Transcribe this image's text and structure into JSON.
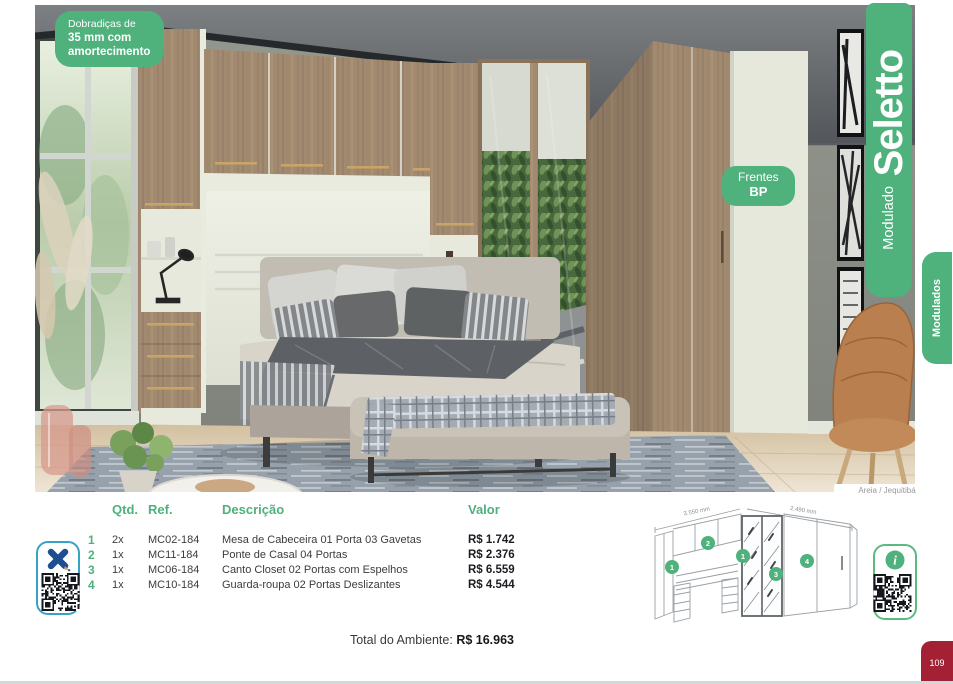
{
  "page": {
    "number": "109"
  },
  "photo": {
    "badge_hinges": {
      "line1": "Dobradiças de",
      "line2": "35 mm com",
      "line3": "amortecimento"
    },
    "badge_fronts": {
      "line1": "Frentes",
      "line2": "BP"
    },
    "caption": "Areia / Jequitibá"
  },
  "banner": {
    "title": "Seletto",
    "subtitle": "Modulado"
  },
  "side_tab": {
    "label": "Modulados"
  },
  "table": {
    "headers": {
      "qtd": "Qtd.",
      "ref": "Ref.",
      "desc": "Descrição",
      "valor": "Valor"
    },
    "rows": [
      {
        "num": "1",
        "qtd": "2x",
        "ref": "MC02-184",
        "desc": "Mesa de Cabeceira 01 Porta 03 Gavetas",
        "valor": "R$ 1.742"
      },
      {
        "num": "2",
        "qtd": "1x",
        "ref": "MC11-184",
        "desc": "Ponte de Casal 04 Portas",
        "valor": "R$ 2.376"
      },
      {
        "num": "3",
        "qtd": "1x",
        "ref": "MC06-184",
        "desc": "Canto Closet 02 Portas com Espelhos",
        "valor": "R$ 6.559"
      },
      {
        "num": "4",
        "qtd": "1x",
        "ref": "MC10-184",
        "desc": "Guarda-roupa 02 Portas Deslizantes",
        "valor": "R$ 4.544"
      }
    ]
  },
  "total": {
    "label": "Total do Ambiente:",
    "value": "R$ 16.963"
  },
  "diagram": {
    "dim_left": "3.550 mm",
    "dim_right": "2.490 mm",
    "markers": [
      "1",
      "2",
      "1",
      "3",
      "4"
    ]
  },
  "colors": {
    "green": "#4FB17C",
    "red": "#A32035",
    "teal": "#35A3C6",
    "blue": "#1D4E8F"
  }
}
